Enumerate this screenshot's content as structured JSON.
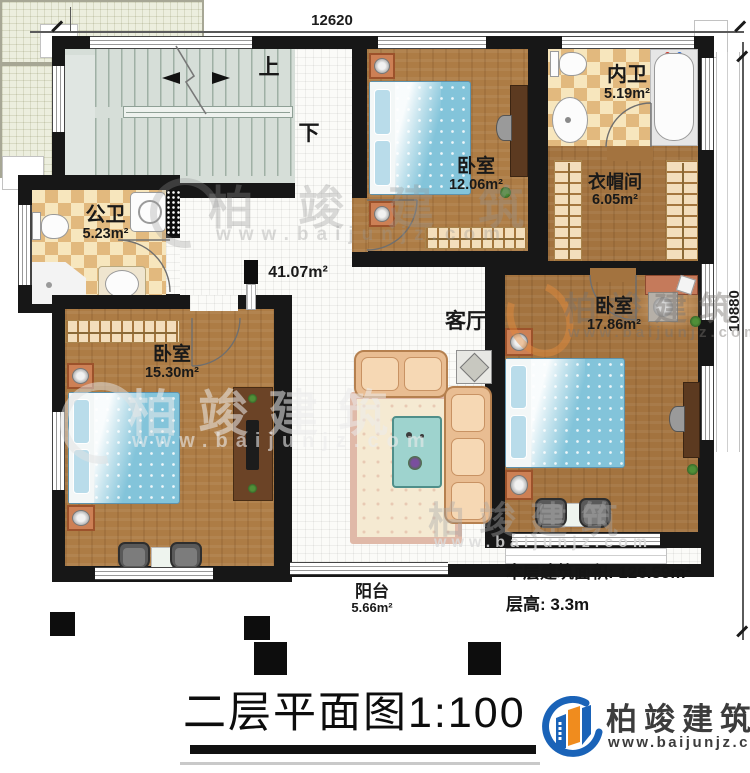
{
  "title": {
    "text": "二层平面图1:100"
  },
  "dimensions": {
    "width_mm": "12620",
    "height_mm": "10880"
  },
  "stairs": {
    "up": "上",
    "down": "下"
  },
  "rooms": {
    "public_bath": {
      "name": "公卫",
      "area": "5.23m²"
    },
    "bedroom_top": {
      "name": "卧室",
      "area": "12.06m²"
    },
    "ensuite_bath": {
      "name": "内卫",
      "area": "5.19m²"
    },
    "cloakroom": {
      "name": "衣帽间",
      "area": "6.05m²"
    },
    "living_room": {
      "name": "客厅",
      "area": "41.07m²"
    },
    "bedroom_left": {
      "name": "卧室",
      "area": "15.30m²"
    },
    "bedroom_right": {
      "name": "卧室",
      "area": "17.86m²"
    },
    "balcony": {
      "name": "阳台",
      "area": "5.66m²"
    }
  },
  "notes": {
    "floor_area_label": "本层建筑面积:",
    "floor_area_value": "126.59m²",
    "floor_height_label": "层高:",
    "floor_height_value": "3.3m"
  },
  "branding": {
    "company": "柏竣建筑",
    "website": "www.baijunjz.com"
  },
  "watermark": {
    "company": "柏竣建筑",
    "website": "www.baijunjz.com"
  },
  "colors": {
    "wall": "#171717",
    "wood_floor": "#ad7c45",
    "wood_floor_dark": "#a3733f",
    "hall_tile": "#fbfbf8",
    "bath_checker_tan": "#e2b97e",
    "bath_checker_cream": "#f7e6bd",
    "stair_floor": "#d6ded8",
    "balcony_tile": "#eceede",
    "bed_blue": "#83c4da",
    "sofa_tan": "#e9bd92",
    "logo_blue": "#1a63b8",
    "logo_orange": "#f08c1e"
  }
}
